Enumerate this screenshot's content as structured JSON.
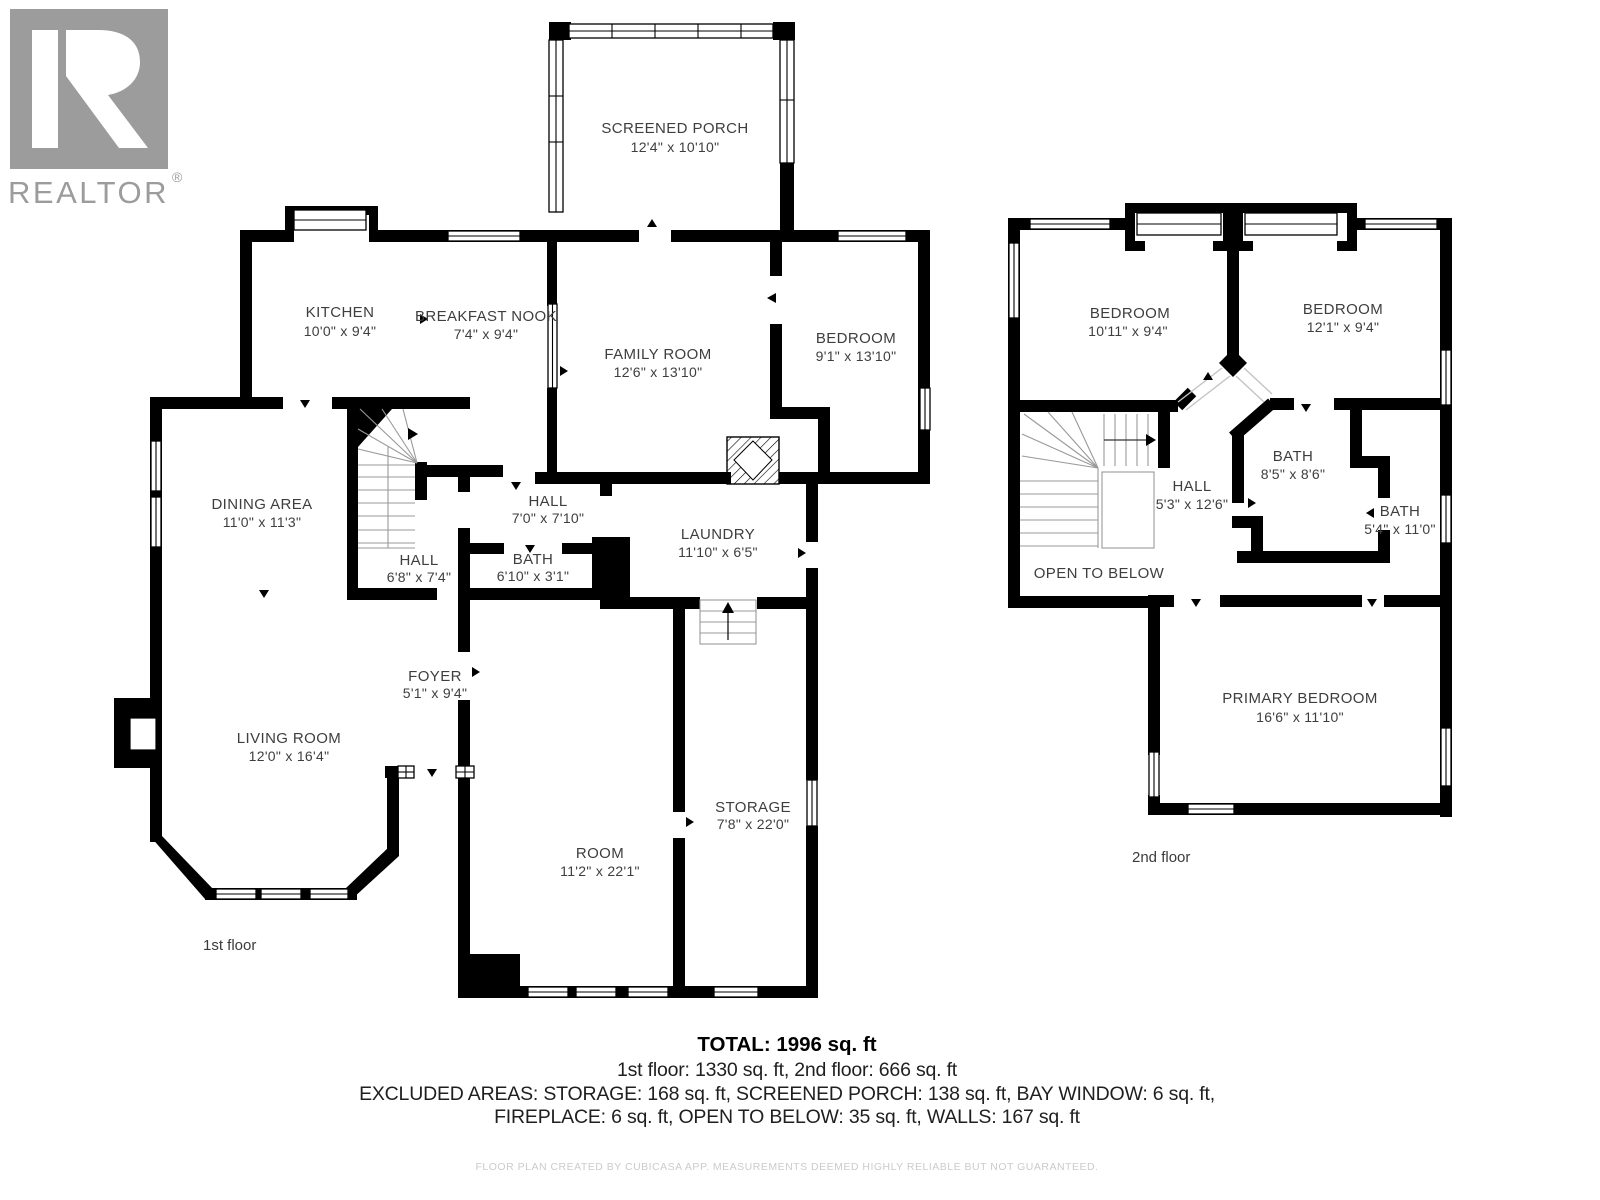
{
  "branding": {
    "logo_letter": "R",
    "logo_text": "REALTOR",
    "registered": "®"
  },
  "colors": {
    "wall": "#000000",
    "label": "#3e3e3e",
    "logo_gray": "#9c9c9c",
    "disclaimer_gray": "#cbcbcb"
  },
  "floor1": {
    "label": "1st floor",
    "rooms": [
      {
        "name": "SCREENED PORCH",
        "dims": "12'4\" x 10'10\""
      },
      {
        "name": "KITCHEN",
        "dims": "10'0\" x 9'4\""
      },
      {
        "name": "BREAKFAST NOOK",
        "dims": "7'4\" x 9'4\""
      },
      {
        "name": "FAMILY ROOM",
        "dims": "12'6\" x 13'10\""
      },
      {
        "name": "BEDROOM",
        "dims": "9'1\" x 13'10\""
      },
      {
        "name": "DINING AREA",
        "dims": "11'0\" x 11'3\""
      },
      {
        "name": "HALL",
        "dims": "7'0\" x 7'10\""
      },
      {
        "name": "LAUNDRY",
        "dims": "11'10\" x 6'5\""
      },
      {
        "name": "HALL",
        "dims": "6'8\" x 7'4\""
      },
      {
        "name": "BATH",
        "dims": "6'10\" x 3'1\""
      },
      {
        "name": "FOYER",
        "dims": "5'1\" x 9'4\""
      },
      {
        "name": "LIVING ROOM",
        "dims": "12'0\" x 16'4\""
      },
      {
        "name": "ROOM",
        "dims": "11'2\" x 22'1\""
      },
      {
        "name": "STORAGE",
        "dims": "7'8\" x 22'0\""
      }
    ]
  },
  "floor2": {
    "label": "2nd floor",
    "rooms": [
      {
        "name": "BEDROOM",
        "dims": "10'11\" x 9'4\""
      },
      {
        "name": "BEDROOM",
        "dims": "12'1\" x 9'4\""
      },
      {
        "name": "BATH",
        "dims": "8'5\" x 8'6\""
      },
      {
        "name": "HALL",
        "dims": "5'3\" x 12'6\""
      },
      {
        "name": "BATH",
        "dims": "5'4\" x 11'0\""
      },
      {
        "name": "OPEN TO BELOW",
        "dims": ""
      },
      {
        "name": "PRIMARY BEDROOM",
        "dims": "16'6\" x 11'10\""
      }
    ]
  },
  "summary": {
    "total": "TOTAL: 1996 sq. ft",
    "floors": "1st floor: 1330 sq. ft, 2nd floor: 666 sq. ft",
    "excluded_line1": "EXCLUDED AREAS: STORAGE: 168 sq. ft, SCREENED PORCH: 138 sq. ft, BAY WINDOW: 6 sq. ft,",
    "excluded_line2": "FIREPLACE: 6 sq. ft, OPEN TO BELOW: 35 sq. ft, WALLS: 167 sq. ft"
  },
  "disclaimer": "FLOOR PLAN CREATED BY CUBICASA APP. MEASUREMENTS DEEMED HIGHLY RELIABLE BUT NOT GUARANTEED."
}
